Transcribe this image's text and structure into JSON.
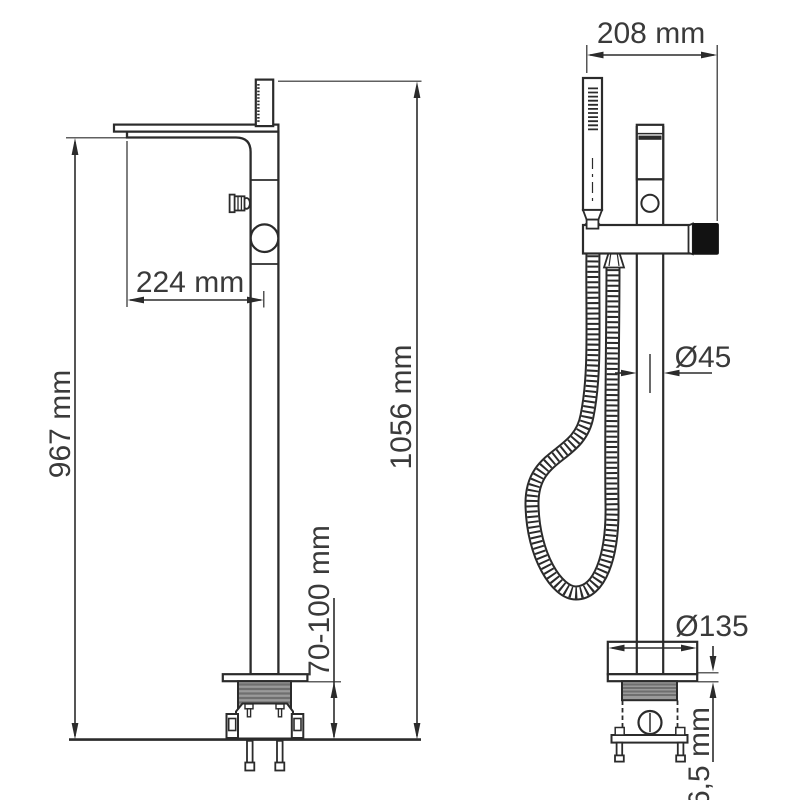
{
  "page": {
    "description": "Technical dimension drawing of a freestanding floor-mounted bathtub mixer tap with hand shower, two projection views",
    "background": "#ffffff"
  },
  "style": {
    "line_color": "#2b2b2b",
    "dim_text_color": "#3a3a3a",
    "thread_fill": "#9a9a9a",
    "thread_stripe": "#6f6f6f",
    "handle_fill": "#121212"
  },
  "views": {
    "front": {
      "label": "front-view",
      "dimensions": {
        "spout_reach": "224 mm",
        "spout_height": "967 mm",
        "total_height": "1056 mm",
        "floor_clearance": "70-100 mm"
      }
    },
    "side": {
      "label": "side-view",
      "dimensions": {
        "body_width": "208 mm",
        "column_diameter": "Ø45",
        "base_diameter": "Ø135",
        "base_plate_thickness": "6,5 mm"
      }
    }
  }
}
